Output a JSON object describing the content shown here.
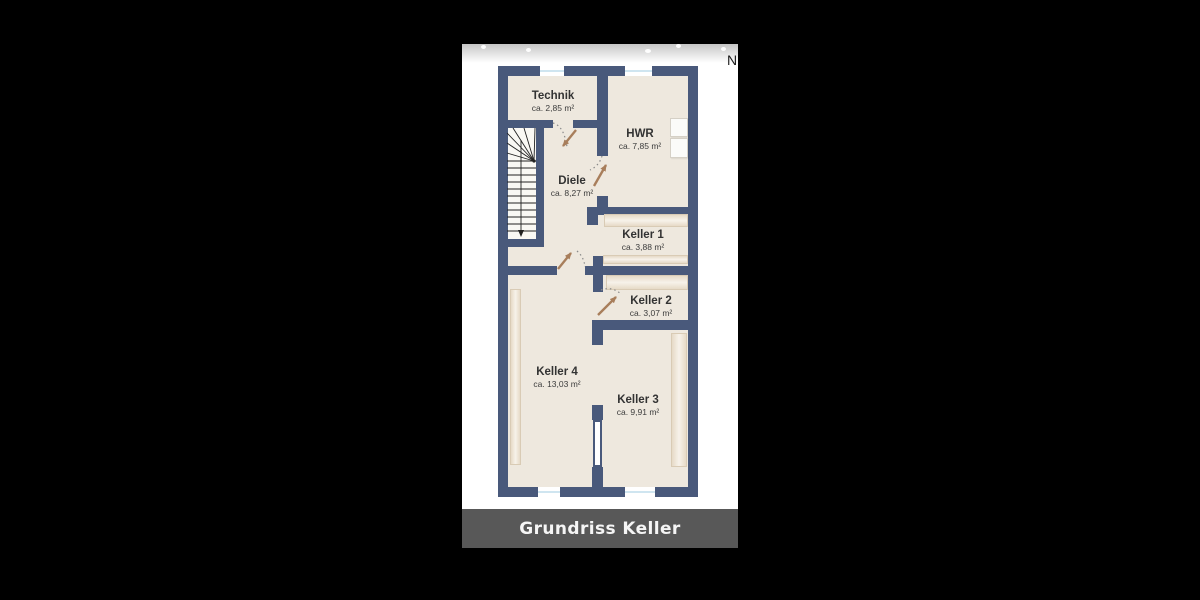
{
  "view": {
    "north_indicator": "N",
    "caption": "Grundriss Keller"
  },
  "rooms": [
    {
      "name": "Technik",
      "area": "ca. 2,85 m²"
    },
    {
      "name": "HWR",
      "area": "ca. 7,85 m²"
    },
    {
      "name": "Diele",
      "area": "ca. 8,27 m²"
    },
    {
      "name": "Keller 1",
      "area": "ca. 3,88 m²"
    },
    {
      "name": "Keller 2",
      "area": "ca. 3,07 m²"
    },
    {
      "name": "Keller 4",
      "area": "ca. 13,03 m²"
    },
    {
      "name": "Keller 3",
      "area": "ca. 9,91 m²"
    }
  ],
  "colors": {
    "wall": "#49597b",
    "room_fill": "#eee8de",
    "stair_fill": "#f9f8f4",
    "window_blue": "#cfe5f0",
    "door_arrow": "#a87e5b",
    "shelf_edge": "#e6dac7",
    "shelf_mid": "#f7f2ea",
    "caption_bg": "#585858",
    "caption_text": "#f5f5f5",
    "photo_black": "#000000",
    "label_text": "#333333"
  }
}
